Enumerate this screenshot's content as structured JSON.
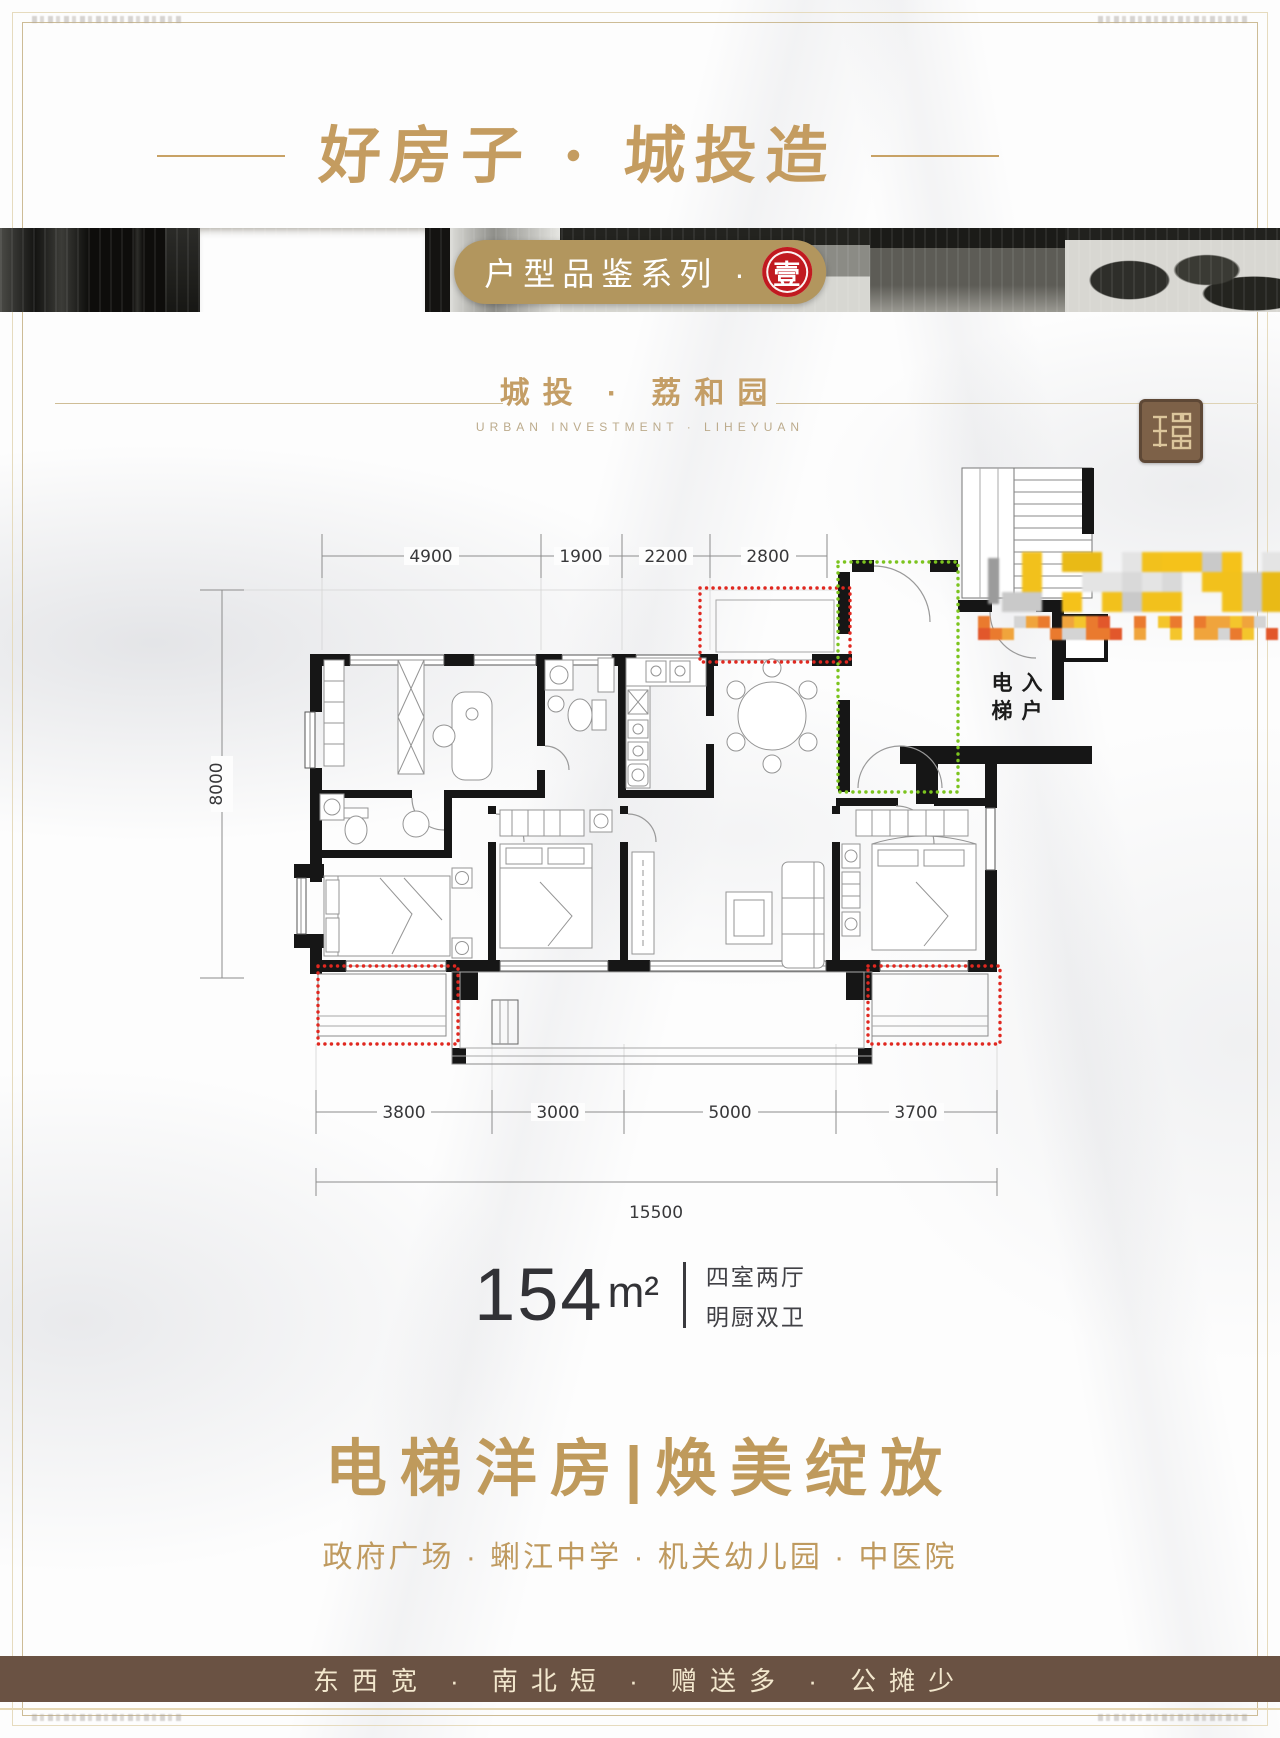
{
  "poster": {
    "header": {
      "calligraphy_title": "好房子 · 城投造"
    },
    "series": {
      "label": "户型品鉴系列 ·",
      "number": "壹"
    },
    "brand": {
      "cn": "城投 · 荔和园",
      "en": "URBAN INVESTMENT · LIHEYUAN"
    },
    "floor_plan": {
      "dims_top": [
        "4900",
        "1900",
        "2200",
        "2800"
      ],
      "dim_left": "8000",
      "dims_bottom": [
        "3800",
        "3000",
        "5000",
        "3700"
      ],
      "dim_total": "15500",
      "elevator_chars": [
        "电",
        "梯",
        "入",
        "户"
      ]
    },
    "unit": {
      "area": "154",
      "unit": "m²",
      "tag1": "四室两厅",
      "tag2": "明厨双卫"
    },
    "headline": {
      "main": "电梯洋房|焕美绽放",
      "sub": "政府广场 · 蜊江中学 · 机关幼儿园 · 中医院"
    },
    "footer": {
      "slogan": "东西宽 · 南北短 · 赠送多 · 公摊少"
    },
    "colors": {
      "gold": "#c49c60",
      "badge_gold": "#b2965e",
      "seal_red": "#c11a20",
      "red_dotted": "#e02820",
      "green_dotted": "#7cc41f",
      "banner_brown": "#6a5243"
    }
  }
}
